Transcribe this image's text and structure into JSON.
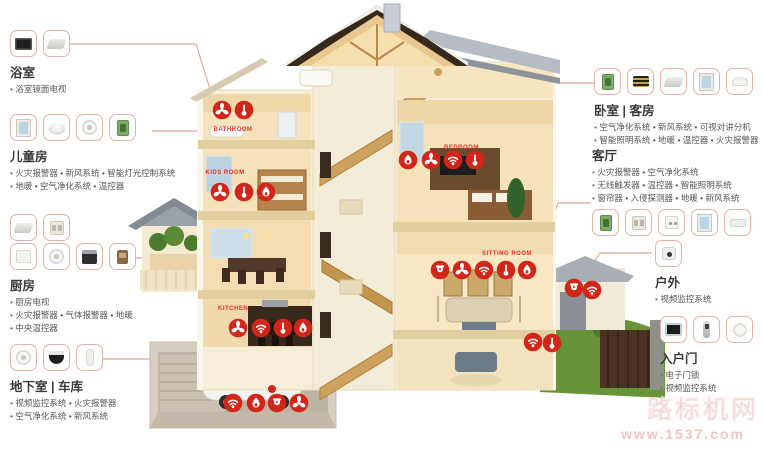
{
  "watermark": {
    "text": "路标机网",
    "url": "www.1537.com"
  },
  "callouts": {
    "bathroom": {
      "title": "浴室",
      "lines": [
        "浴室镜面电视"
      ],
      "icons": [
        "mirror-tv-icon",
        "ceiling-panel-icon"
      ]
    },
    "kids_room": {
      "title": "儿童房",
      "lines": [
        "火灾报警器 • 新风系统 • 智能灯光控制系统",
        "地暖 • 空气净化系统 • 温控器"
      ],
      "icons": [
        "window-icon",
        "ceiling-lamp-icon",
        "smoke-detector-icon",
        "control-panel-icon"
      ]
    },
    "kitchen": {
      "title": "厨房",
      "lines": [
        "厨房电视",
        "火灾报警器 • 气体报警器 • 地暖",
        "中央温控器"
      ],
      "icons": [
        "flat-panel-icon",
        "wall-switch-icon",
        "air-purifier-icon",
        "gas-detector-icon",
        "oven-icon",
        "thermostat-icon"
      ]
    },
    "basement": {
      "title": "地下室 | 车库",
      "lines": [
        "视频监控系统 • 火灾报警器",
        "空气净化系统 • 新风系统"
      ],
      "icons": [
        "smoke-detector-icon",
        "dome-camera-icon",
        "sensor-icon"
      ]
    },
    "bedroom": {
      "title": "卧室 | 客房",
      "lines": [
        "空气净化系统 • 新风系统 • 可视对讲分机",
        "智能照明系统 • 地暖 • 温控器 • 火灾报警器"
      ],
      "icons": [
        "control-panel-icon",
        "air-vent-icon",
        "flat-panel-icon",
        "window-icon",
        "curved-speaker-icon"
      ]
    },
    "living_room": {
      "title": "客厅",
      "lines": [
        "火灾报警器 • 空气净化系统",
        "无线触发器 • 温控器 • 智能照明系统",
        "窗帘器 • 入侵探测器 • 地暖 • 新风系统"
      ],
      "icons": [
        "control-panel-icon",
        "wall-switch-icon",
        "keypad-icon",
        "window-icon",
        "wifi-router-icon"
      ]
    },
    "outdoor": {
      "title": "户外",
      "lines": [
        "视频监控系统"
      ],
      "icons": [
        "ptz-camera-icon"
      ]
    },
    "entrance": {
      "title": "入户门",
      "lines": [
        "电子门锁",
        "视频监控系统"
      ],
      "icons": [
        "video-intercom-icon",
        "door-lock-icon",
        "doorbell-icon"
      ]
    }
  },
  "house": {
    "labels": {
      "bathroom": "BATHROOM",
      "kids_room": "KIDS ROOM",
      "kitchen": "KITCHEN",
      "bedroom": "BEDROOM",
      "sitting_room": "SITTING ROOM"
    },
    "badge_color": "#d2261a",
    "badge_glyphs": [
      "fan-icon",
      "wifi-icon",
      "thermometer-icon",
      "flame-icon",
      "camera-icon"
    ]
  }
}
